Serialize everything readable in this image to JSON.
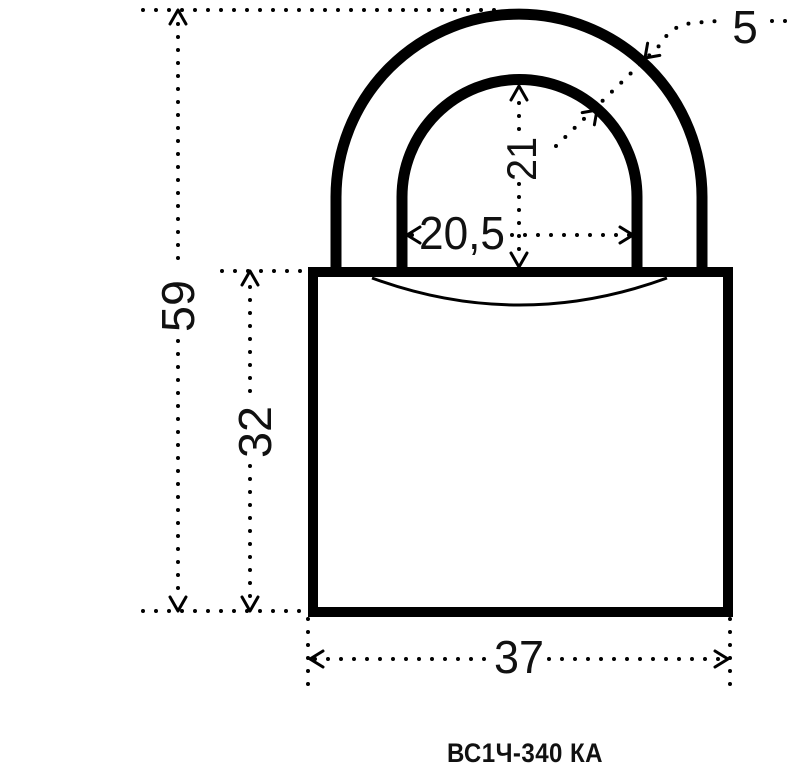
{
  "page": {
    "background_color": "#ffffff",
    "ink_color": "#000000"
  },
  "drawing": {
    "model_caption": "ВС1Ч-340 КА",
    "dimensions": {
      "total_height": "59",
      "body_height": "32",
      "body_width": "37",
      "shackle_opening_width": "20,5",
      "shackle_opening_height": "21",
      "shackle_diameter": "5"
    }
  }
}
